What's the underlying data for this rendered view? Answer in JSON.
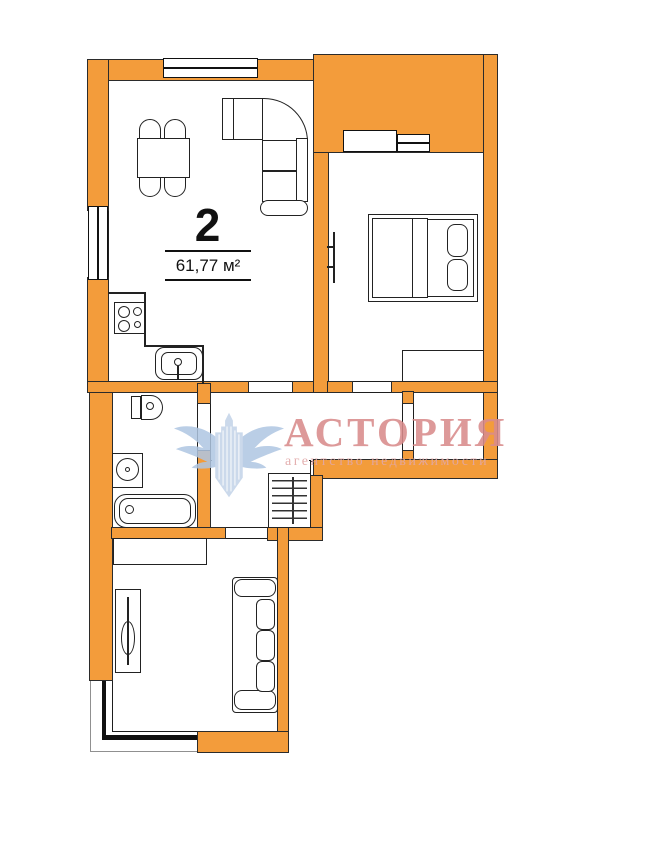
{
  "meta": {
    "type_label": "2",
    "area_label": "61,77 м²"
  },
  "watermark": {
    "title": "АСТОРИЯ",
    "subtitle": "агентство недвижимости",
    "logo": "eagle-wings-emblem",
    "title_color": "#D98C8C",
    "subtitle_color": "#E2A8A8",
    "logo_color": "#AFC6E2"
  },
  "colors": {
    "wall": "#F39C3B",
    "outline": "#2B2B2B",
    "background": "#FFFFFF",
    "furniture_line": "#222222"
  },
  "rooms": [
    "kitchen-living-room",
    "bedroom",
    "balcony",
    "storage-closet",
    "bathroom",
    "hallway",
    "living-room",
    "lower-bay-balcony"
  ],
  "furniture": [
    "dining-table-with-four-chairs",
    "corner-sofa",
    "kitchen-stove",
    "kitchen-counter",
    "kitchen-sink",
    "toilet",
    "washing-machine",
    "bathtub",
    "coat-rack",
    "double-bed-with-pillows",
    "wall-radiator",
    "bedroom-wardrobe",
    "living-room-wardrobe",
    "dressing-table",
    "straight-sofa",
    "windows",
    "balcony-door"
  ]
}
